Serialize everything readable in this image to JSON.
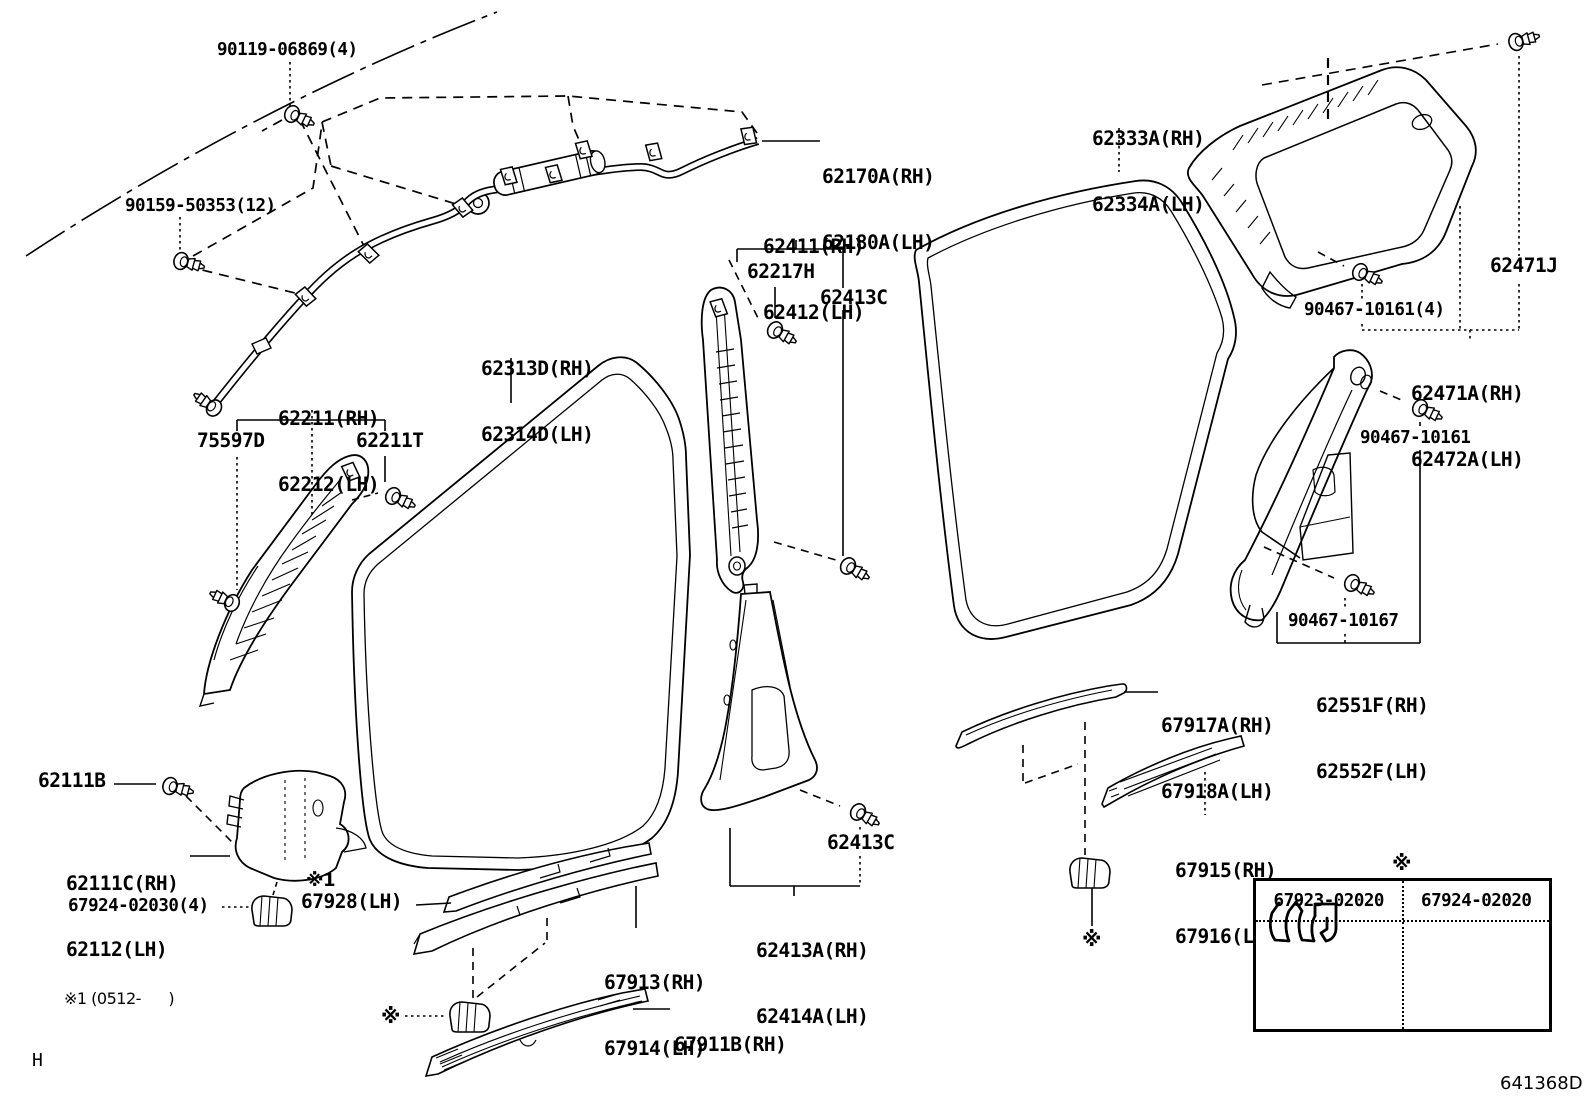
{
  "doc": {
    "drawing_number": "641368D",
    "sheet_letter": "H",
    "footnote": "※1 (0512-      )"
  },
  "table": {
    "marker": "※",
    "col1": "67923-02020",
    "col2": "67924-02020"
  },
  "labels": {
    "l90119": {
      "text": "90119-06869(4)"
    },
    "l90159": {
      "text": "90159-50353(12)"
    },
    "l62170a": {
      "line1": "62170A(RH)",
      "line2": "62180A(LH)"
    },
    "l62411": {
      "line1": "62411(RH)",
      "line2": "62412(LH)"
    },
    "l62217h": {
      "text": "62217H"
    },
    "l62413c_top": {
      "text": "62413C"
    },
    "l62333a": {
      "line1": "62333A(RH)",
      "line2": "62334A(LH)"
    },
    "l62313d": {
      "line1": "62313D(RH)",
      "line2": "62314D(LH)"
    },
    "l62211": {
      "line1": "62211(RH)",
      "line2": "62212(LH)"
    },
    "l75597d": {
      "text": "75597D"
    },
    "l62211t": {
      "text": "62211T"
    },
    "l62471j": {
      "text": "62471J"
    },
    "l90467_10161_4": {
      "text": "90467-10161(4)"
    },
    "l62471a": {
      "line1": "62471A(RH)",
      "line2": "62472A(LH)"
    },
    "l90467_10161": {
      "text": "90467-10161"
    },
    "l90467_10167": {
      "text": "90467-10167"
    },
    "l62551f": {
      "line1": "62551F(RH)",
      "line2": "62552F(LH)"
    },
    "l67917a": {
      "line1": "67917A(RH)",
      "line2": "67918A(LH)"
    },
    "l67915": {
      "line1": "67915(RH)",
      "line2": "67916(LH)"
    },
    "l62413c_bot": {
      "text": "62413C"
    },
    "l62413a": {
      "line1": "62413A(RH)",
      "line2": "62414A(LH)"
    },
    "l67913": {
      "line1": "67913(RH)",
      "line2": "67914(LH)"
    },
    "l67911b": {
      "line1": "67911B(RH)",
      "line2": "67912A(LH)"
    },
    "l62111b": {
      "text": "62111B"
    },
    "l62111c": {
      "line1": "62111C(RH)",
      "line2": "62112(LH)"
    },
    "l67924": {
      "text": "67924-02030(4)"
    },
    "lnote1": {
      "text": "※1"
    },
    "l67928": {
      "text": "67928(LH)"
    },
    "lstar_left": {
      "text": "※"
    },
    "lstar_right": {
      "text": "※"
    },
    "lstar_table": {
      "text": "※"
    }
  }
}
